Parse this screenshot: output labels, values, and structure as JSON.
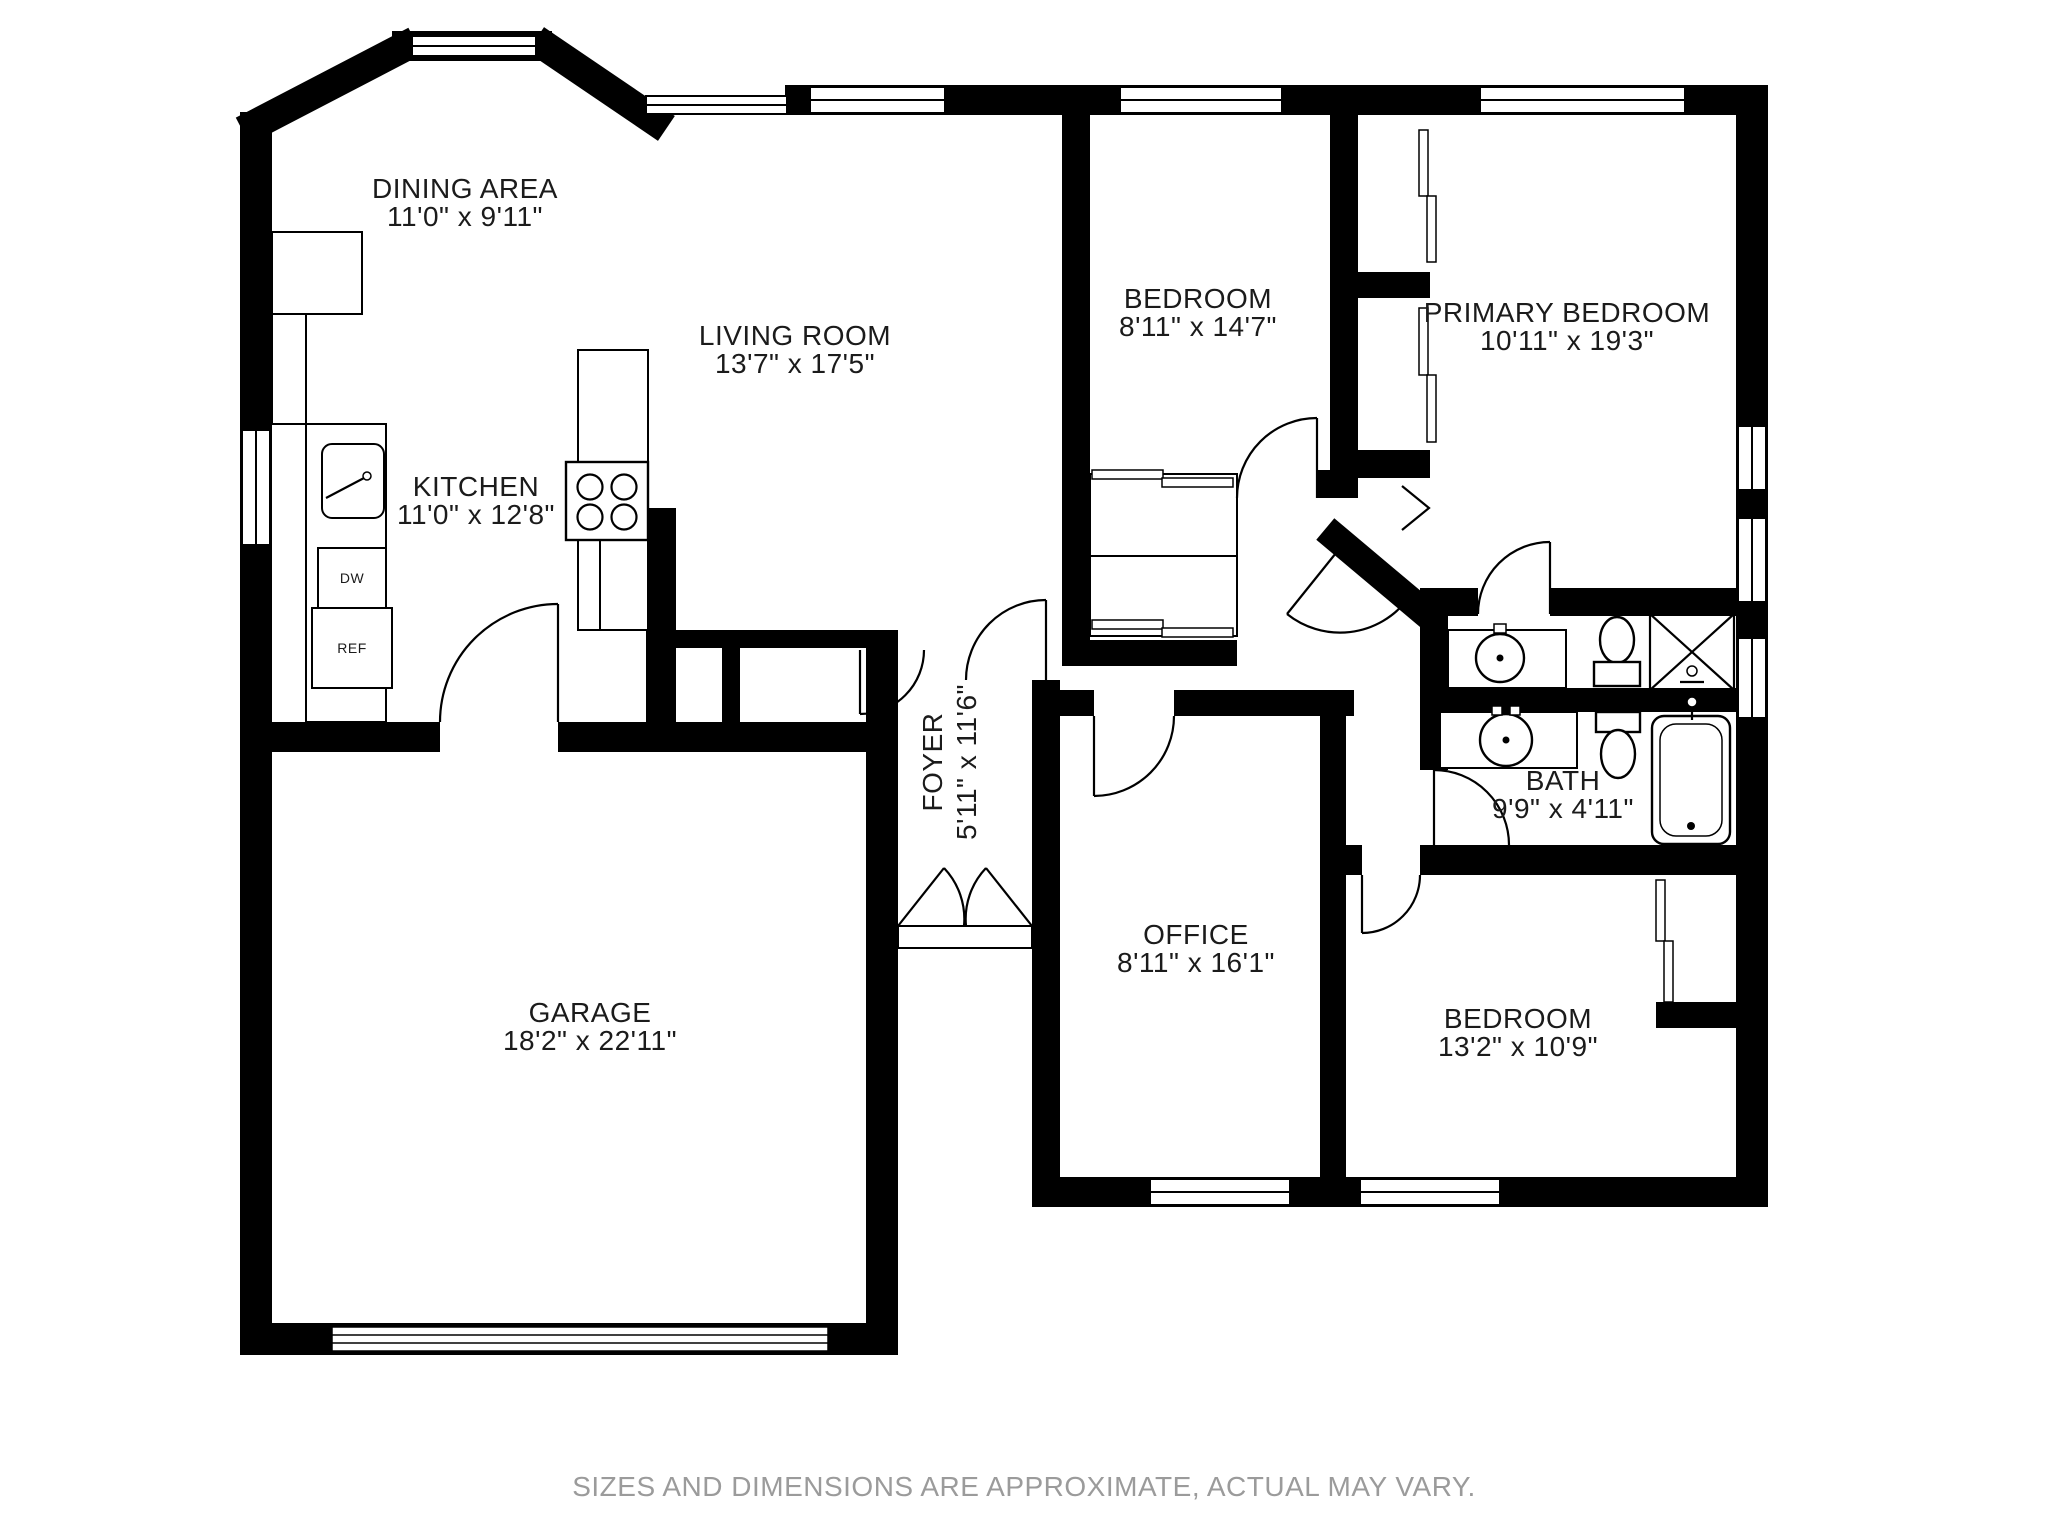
{
  "page": {
    "background": "#ffffff",
    "wall_color": "#000000",
    "label_color": "#1b1b1b",
    "disclaimer_color": "#9b9b9b"
  },
  "rooms": {
    "dining": {
      "name": "DINING AREA",
      "dims": "11'0\" x 9'11\""
    },
    "living": {
      "name": "LIVING ROOM",
      "dims": "13'7\" x 17'5\""
    },
    "kitchen": {
      "name": "KITCHEN",
      "dims": "11'0\" x 12'8\""
    },
    "bedroom_top": {
      "name": "BEDROOM",
      "dims": "8'11\" x 14'7\""
    },
    "primary_bedroom": {
      "name": "PRIMARY BEDROOM",
      "dims": "10'11\" x 19'3\""
    },
    "foyer": {
      "name": "FOYER",
      "dims": "5'11\" x 11'6\""
    },
    "bath": {
      "name": "BATH",
      "dims": "9'9\" x 4'11\""
    },
    "office": {
      "name": "OFFICE",
      "dims": "8'11\" x 16'1\""
    },
    "bedroom_bottom": {
      "name": "BEDROOM",
      "dims": "13'2\" x 10'9\""
    },
    "garage": {
      "name": "GARAGE",
      "dims": "18'2\" x 22'11\""
    }
  },
  "appliances": {
    "dishwasher": "DW",
    "refrigerator": "REF"
  },
  "footer": {
    "disclaimer": "SIZES AND DIMENSIONS ARE APPROXIMATE, ACTUAL MAY VARY."
  }
}
